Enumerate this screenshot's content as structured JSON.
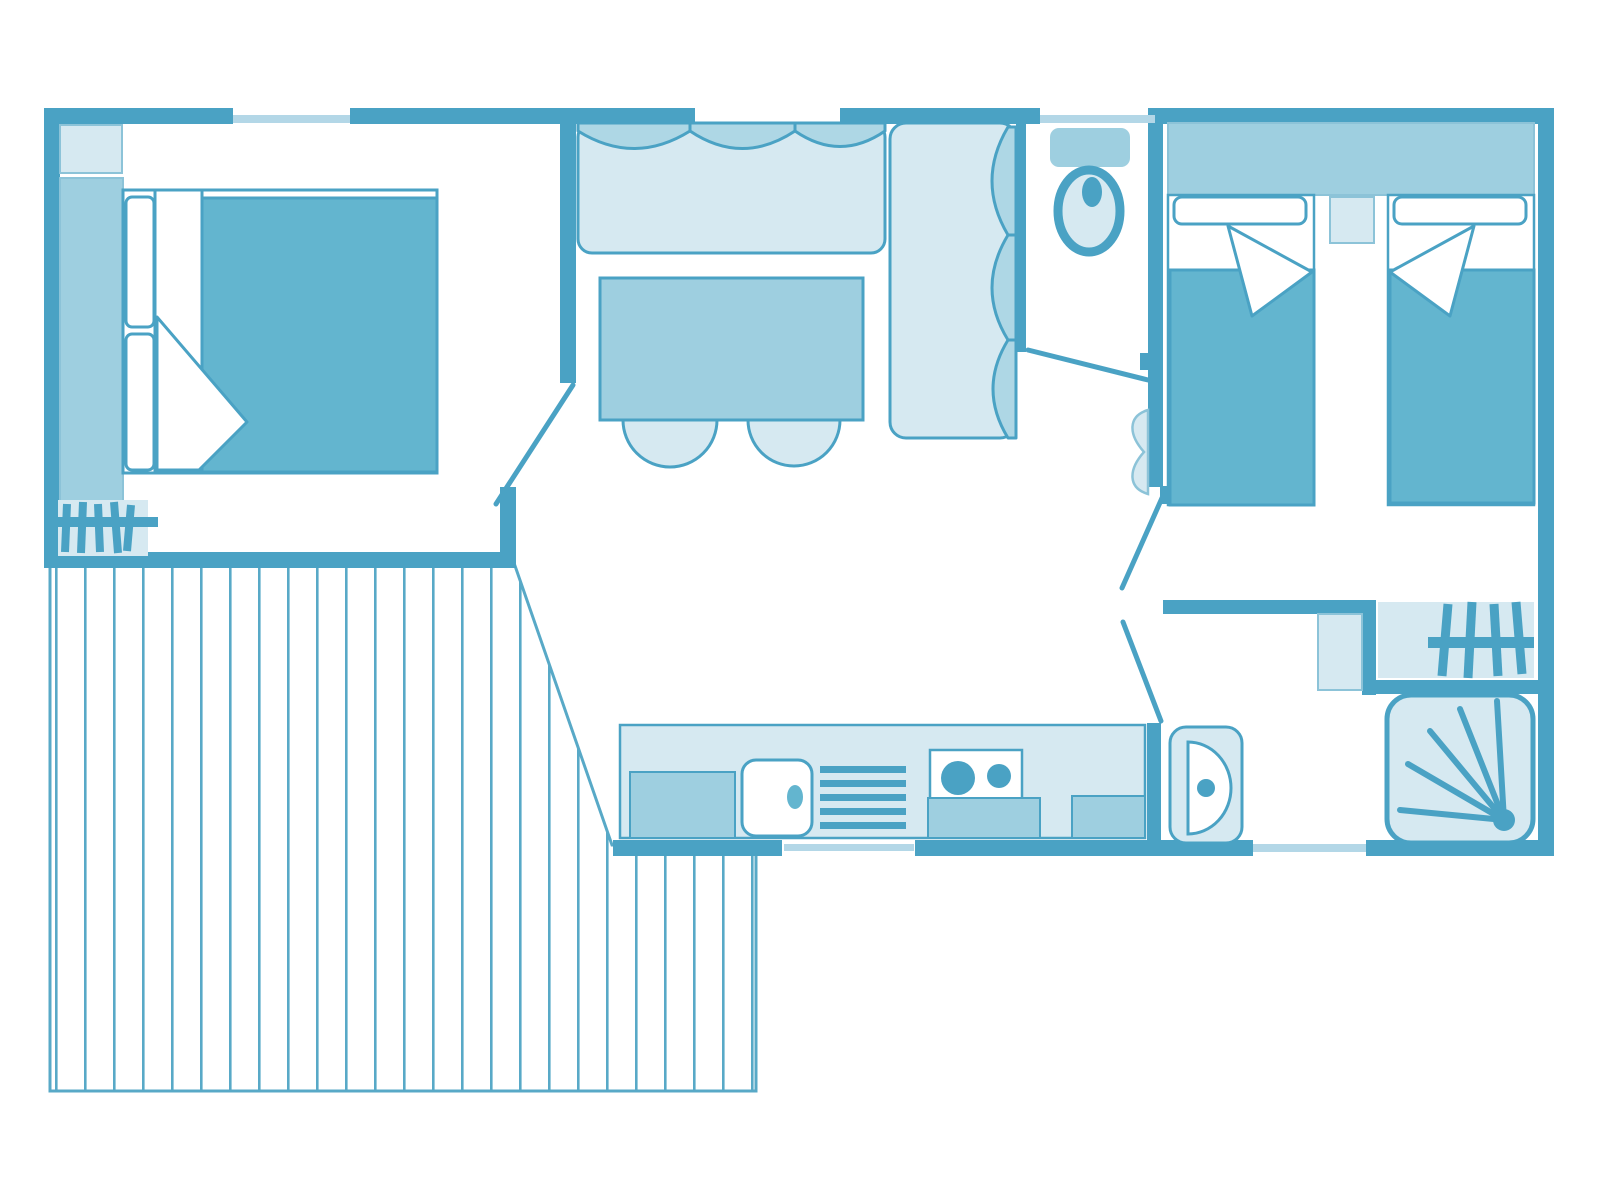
{
  "document": {
    "kind": "floor-plan",
    "view": "top-down",
    "style": "monochrome-teal line drawing on white",
    "visible_text": []
  },
  "palette": {
    "wall": "#4aa2c4",
    "teal": "#63b5cf",
    "mid": "#9ecfe0",
    "cushion": "#aed7e5",
    "light": "#d6e9f1",
    "sill": "#b3d7e7",
    "soft": "#8cc3d8",
    "deck": "#58a9c7",
    "paper": "#ffffff"
  },
  "rooms": [
    {
      "name": "master-bedroom",
      "furniture": [
        "double-bed",
        "pillows",
        "duvet-folded-corner",
        "wardrobe-strip",
        "shelf",
        "hatched-mat",
        "door-swing"
      ]
    },
    {
      "name": "living-dining",
      "furniture": [
        "l-shaped-bench-sofa",
        "seat-cushions",
        "dining-table",
        "two-stools",
        "window-front"
      ]
    },
    {
      "name": "wc",
      "furniture": [
        "toilet-with-cistern",
        "door-swing"
      ]
    },
    {
      "name": "twin-bedroom",
      "furniture": [
        "single-bed-left",
        "single-bed-right",
        "pillows",
        "duvet-folded-corners",
        "headboard-shelf-band",
        "nightstand",
        "door-leaf",
        "door-swings"
      ]
    },
    {
      "name": "kitchen",
      "furniture": [
        "counter",
        "sink",
        "drainer-rack",
        "two-burner-hob",
        "base-units",
        "entry-door-gap"
      ]
    },
    {
      "name": "shower-room",
      "furniture": [
        "washbasin",
        "shower-tray-with-spray",
        "hatched-mat",
        "niche-shelf",
        "window"
      ]
    },
    {
      "name": "terrace-deck",
      "furniture": [
        "plank-stripes",
        "diagonal-edge"
      ]
    }
  ],
  "counts": {
    "top-wall-window-gaps": 3,
    "sofa-top-cushions": 3,
    "sofa-side-cushions": 3,
    "stools": 2,
    "hob-burners": 2,
    "drainer-bars": 5,
    "shower-spray-rays": 5,
    "deck-stripe-spacing-px": 29
  }
}
